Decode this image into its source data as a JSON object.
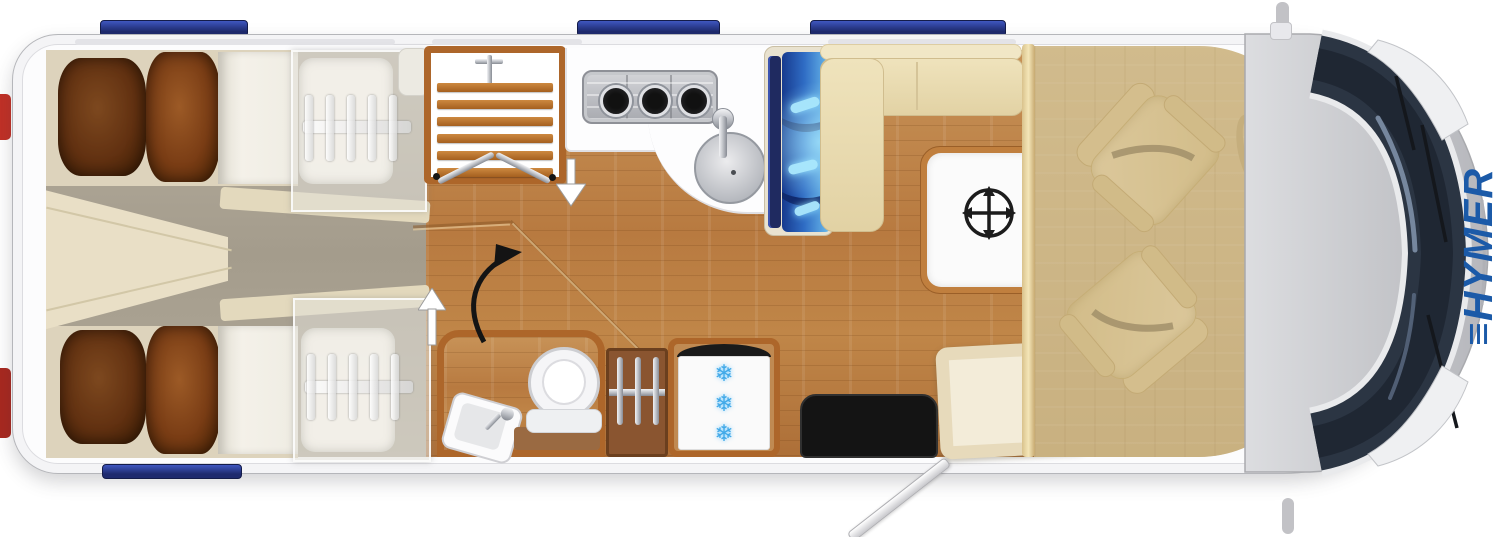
{
  "brand": {
    "mark": "≡",
    "name": "HYMER",
    "color": "#1b5aa8"
  },
  "diagram": {
    "type": "motorhome-floorplan",
    "view": "top-down",
    "areas": [
      {
        "id": "rear-bedroom",
        "fixtures": [
          "single-bed-top",
          "single-bed-bottom",
          "bed-pillows",
          "bed-extension-overlays",
          "slatted-frame-symbols",
          "center-console"
        ]
      },
      {
        "id": "washroom",
        "fixtures": [
          "shower-with-duckboard",
          "folding-shower-doors",
          "shower-mixer",
          "toilet",
          "tilted-washbasin",
          "wardrobe-with-hangers"
        ]
      },
      {
        "id": "kitchen",
        "fixtures": [
          "three-burner-hob",
          "round-sink-with-tap",
          "l-shaped-counter",
          "illuminated-refrigerator",
          "freezer-compartment"
        ]
      },
      {
        "id": "lounge",
        "fixtures": [
          "l-shaped-bench",
          "movable-table"
        ]
      },
      {
        "id": "entrance",
        "fixtures": [
          "entry-step-mat",
          "open-entry-door",
          "step-platform"
        ]
      },
      {
        "id": "cab",
        "fixtures": [
          "driver-swivel-seat",
          "passenger-swivel-seat",
          "steering-wheel",
          "windshield",
          "wipers",
          "headlights",
          "side-mirrors"
        ]
      }
    ],
    "roof": {
      "skylight_count": 3,
      "rear_window_count": 1
    }
  },
  "icons": {
    "snowflake": "❄",
    "table_move": "four-way-arrow",
    "walkway_up": "white-up-arrow",
    "walkway_down": "white-down-arrow",
    "turn": "black-curved-arrow"
  },
  "colors": {
    "skylight_blue": "#1e2a6e",
    "fridge_glow": "#6fc0ee",
    "brand_blue": "#1b5aa8",
    "wood_floor": "#b87a40",
    "upholstery_cream": "#ecdfb8",
    "pillow_brown": "#7a3d15",
    "windshield": "#2b3543",
    "body_gray": "#c6c7cb",
    "tail_light_red": "#b8291f",
    "mat_black": "#141414"
  }
}
